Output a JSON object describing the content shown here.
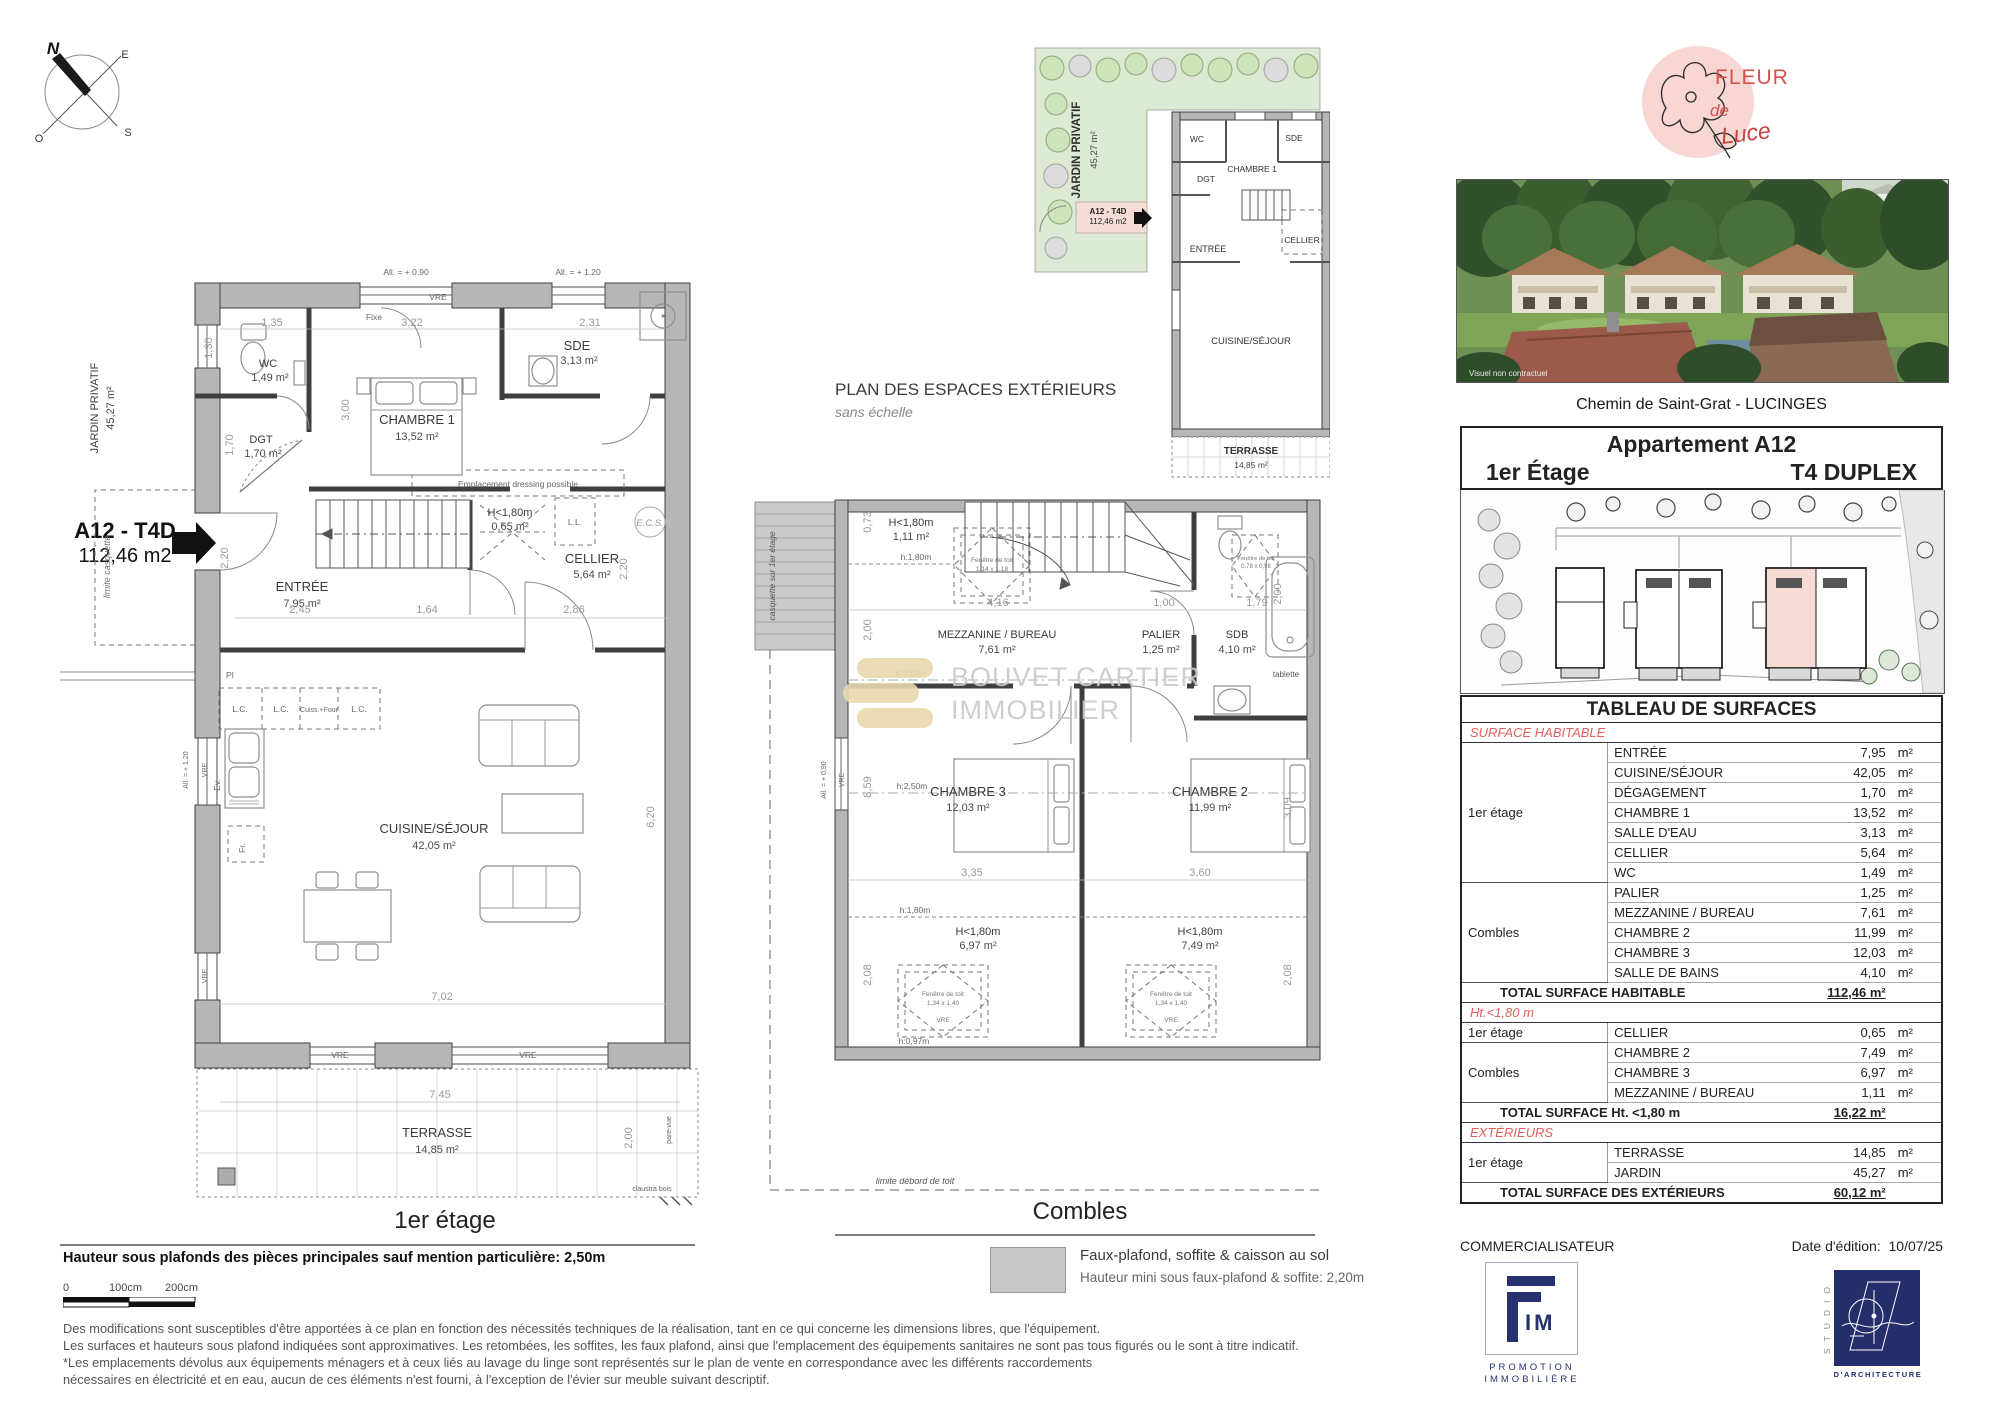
{
  "compass": {
    "n": "N",
    "e": "E",
    "s": "S",
    "o": "O"
  },
  "p1": {
    "caption": "1er étage",
    "jardin": "JARDIN PRIVATIF",
    "jardin_a": "45,27 m²",
    "unit_code": "A12 - T4D",
    "unit_area": "112,46 m2",
    "limite": "limite casquette",
    "wc": "WC",
    "wc_a": "1,49 m²",
    "dgt": "DGT",
    "dgt_a": "1,70 m²",
    "ch1": "CHAMBRE 1",
    "ch1_a": "13,52 m²",
    "sde": "SDE",
    "sde_a": "3,13 m²",
    "entree": "ENTRÉE",
    "entree_a": "7,95 m²",
    "cellier": "CELLIER",
    "cellier_a": "5,64 m²",
    "cuisine": "CUISINE/SÉJOUR",
    "cuisine_a": "42,05 m²",
    "terrasse": "TERRASSE",
    "terrasse_a": "14,85 m²",
    "h180": "H<1,80m",
    "h180_a": "0,65 m²",
    "ll": "L.L.",
    "ecs": "E.C.S.",
    "dressing": "Emplacement dressing possible",
    "lc": "L.C.",
    "cuiss": "Cuiss.+Four",
    "fr": "Fr.",
    "ev": "Ev.",
    "pi": "PI",
    "fixe": "Fixe",
    "vre": "VRE",
    "all090": "All. = + 0.90",
    "all120": "All. = + 1.20",
    "seuil": "Seuil = ± 0.00",
    "pare": "pare-vue",
    "claustra": "claustra bois",
    "d135": "1,35",
    "d322": "3,22",
    "d231": "2,31",
    "d130": "1,30",
    "d300": "3,00",
    "d170": "1,70",
    "d245": "2,45",
    "d164": "1,64",
    "d286": "2,86",
    "d220a": "2,20",
    "d220b": "2,20",
    "d620": "6,20",
    "d702": "7,02",
    "d745": "7,45",
    "d200": "2,00"
  },
  "px": {
    "title": "PLAN DES ESPACES EXTÉRIEURS",
    "subtitle": "sans échelle",
    "jardin": "JARDIN PRIVATIF",
    "jardin_a": "45,27 m²",
    "unit_code": "A12 - T4D",
    "unit_area": "112,46 m2",
    "wc": "WC",
    "sde": "SDE",
    "ch1": "CHAMBRE 1",
    "dgt": "DGT",
    "entree": "ENTRÉE",
    "cellier": "CELLIER",
    "cuisine": "CUISINE/SÉJOUR",
    "terrasse": "TERRASSE",
    "terrasse_a": "14,85 m²"
  },
  "pc": {
    "caption": "Combles",
    "casquette": "casquette sur 1er étage",
    "limite_toit": "limite débord de toit",
    "h180t": "H<1,80m",
    "h180t_a": "1,11 m²",
    "hline": "h:1,80m",
    "h250": "h:2,50m",
    "h097": "h:0,97m",
    "mez": "MEZZANINE / BUREAU",
    "mez_a": "7,61 m²",
    "palier": "PALIER",
    "palier_a": "1,25 m²",
    "sdb": "SDB",
    "sdb_a": "4,10 m²",
    "tablette": "tablette",
    "ch3": "CHAMBRE 3",
    "ch3_a": "12,03 m²",
    "ch2": "CHAMBRE 2",
    "ch2_a": "11,99 m²",
    "h180l": "H<1,80m",
    "h180l_a": "6,97 m²",
    "h180r": "H<1,80m",
    "h180r_a": "7,49 m²",
    "fdt": "Fenêtre de toit",
    "fdt1": "1,14 x 1,18",
    "fdt2": "1,34 x 1,40",
    "fdt3": "0,78 x 0,98",
    "vre": "VRE",
    "all090": "All. = + 0,90",
    "d073": "0,73",
    "d200a": "2,00",
    "d416": "4,16",
    "d100": "1,00",
    "d179": "1,79",
    "d200b": "2,00",
    "d335": "3,35",
    "d360": "3,60",
    "d208a": "2,08",
    "d208b": "2,08",
    "d309": "3,09",
    "d859": "8,59"
  },
  "wm": {
    "l1": "BOUVET CARTIER",
    "l2": "IMMOBILIER"
  },
  "legend": {
    "l1": "Faux-plafond, soffite & caisson au sol",
    "l2": "Hauteur mini sous faux-plafond & soffite: 2,20m"
  },
  "notes": {
    "bold": "Hauteur sous plafonds des pièces principales sauf mention particulière: 2,50m",
    "s0": "0",
    "s1": "100cm",
    "s2": "200cm",
    "lines": [
      "Des modifications sont susceptibles d'être apportées à ce plan en fonction des nécessités techniques de la réalisation, tant en ce qui concerne les dimensions libres, que l'équipement.",
      "Les surfaces et hauteurs sous plafond indiquées sont approximatives. Les retombées, les soffites, les faux plafond, ainsi que l'emplacement des équipements sanitaires ne sont pas tous figurés ou le sont à titre indicatif.",
      "*Les emplacements dévolus aux équipements ménagers et à ceux liés au lavage du linge sont représentés sur le plan de vente en correspondance avec les différents raccordements",
      "nécessaires en électricité et en eau, aucun de ces éléments n'est fourni, à l'exception de l'évier sur meuble suivant descriptif."
    ]
  },
  "rp": {
    "fleur": "FLEUR",
    "de": "de",
    "luce": "Luce",
    "visuel": "Visuel non contractuel",
    "address": "Chemin de Saint-Grat - LUCINGES",
    "apt": "Appartement A12",
    "floor": "1er Étage",
    "type": "T4 DUPLEX",
    "tbl": {
      "title": "TABLEAU DE SURFACES",
      "unit": "m²",
      "h_head": "SURFACE HABITABLE",
      "g1": "1er étage",
      "g2": "Combles",
      "hab1": [
        [
          "ENTRÉE",
          "7,95"
        ],
        [
          "CUISINE/SÉJOUR",
          "42,05"
        ],
        [
          "DÉGAGEMENT",
          "1,70"
        ],
        [
          "CHAMBRE 1",
          "13,52"
        ],
        [
          "SALLE D'EAU",
          "3,13"
        ],
        [
          "CELLIER",
          "5,64"
        ],
        [
          "WC",
          "1,49"
        ]
      ],
      "hab2": [
        [
          "PALIER",
          "1,25"
        ],
        [
          "MEZZANINE / BUREAU",
          "7,61"
        ],
        [
          "CHAMBRE 2",
          "11,99"
        ],
        [
          "CHAMBRE 3",
          "12,03"
        ],
        [
          "SALLE DE BAINS",
          "4,10"
        ]
      ],
      "hab_total": "TOTAL SURFACE HABITABLE",
      "hab_total_v": "112,46 m²",
      "ht_head": "Ht.<1,80 m",
      "ht1": [
        [
          "CELLIER",
          "0,65"
        ]
      ],
      "ht2": [
        [
          "CHAMBRE 2",
          "7,49"
        ],
        [
          "CHAMBRE 3",
          "6,97"
        ],
        [
          "MEZZANINE / BUREAU",
          "1,11"
        ]
      ],
      "ht_total": "TOTAL SURFACE Ht. <1,80 m",
      "ht_total_v": "16,22 m²",
      "ex_head": "EXTÉRIEURS",
      "ex1": [
        [
          "TERRASSE",
          "14,85"
        ],
        [
          "JARDIN",
          "45,27"
        ]
      ],
      "ex_total": "TOTAL SURFACE DES EXTÉRIEURS",
      "ex_total_v": "60,12 m²"
    },
    "commercial": "COMMERCIALISATEUR",
    "date_label": "Date d'édition:",
    "date": "10/07/25",
    "fim_im": "IM",
    "fim_l1": "PROMOTION",
    "fim_l2": "IMMOBILIÈRE",
    "studio": "STUDIO",
    "studio_sub": "D'ARCHITECTURE"
  }
}
